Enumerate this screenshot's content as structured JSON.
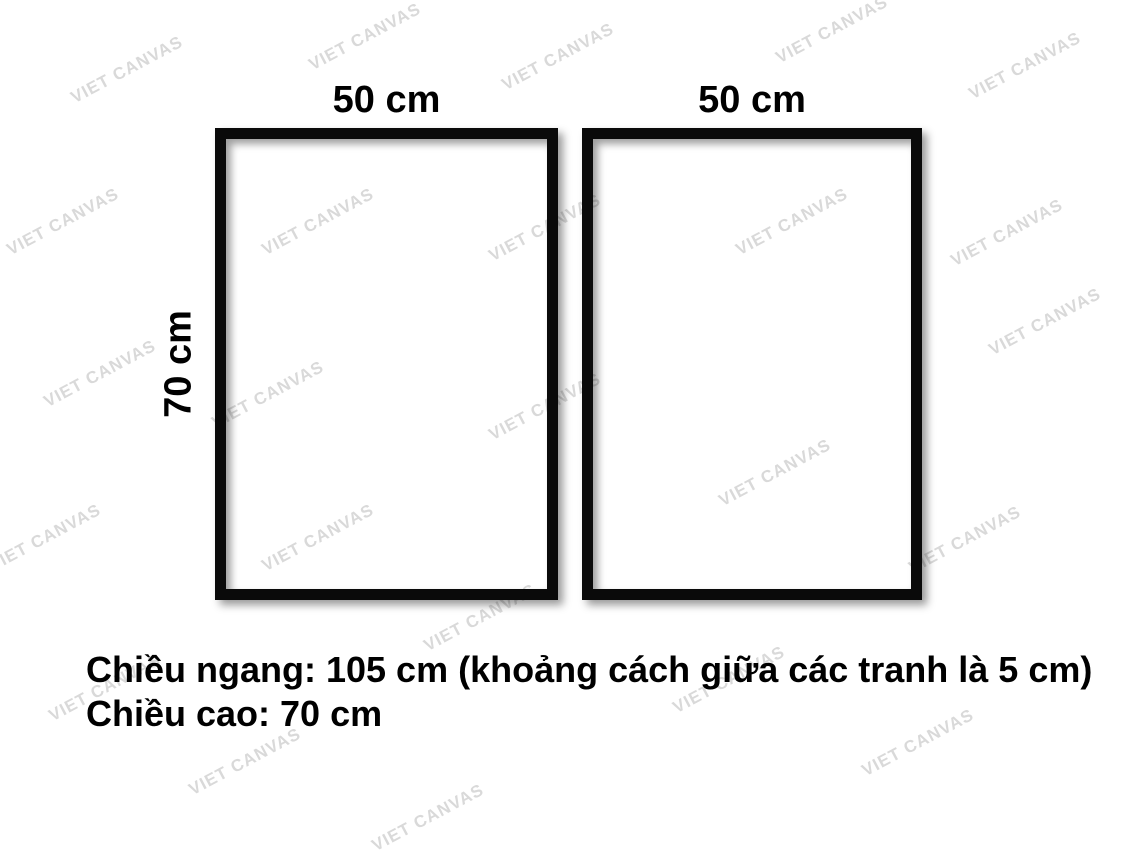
{
  "background_color": "#ffffff",
  "watermark": {
    "text": "VIET CANVAS",
    "color": "#d9d9d9",
    "angle_deg": -28,
    "positions": [
      {
        "x": 127,
        "y": 70
      },
      {
        "x": 365,
        "y": 37
      },
      {
        "x": 558,
        "y": 57
      },
      {
        "x": 832,
        "y": 30
      },
      {
        "x": 1025,
        "y": 66
      },
      {
        "x": 63,
        "y": 222
      },
      {
        "x": 318,
        "y": 222
      },
      {
        "x": 545,
        "y": 228
      },
      {
        "x": 792,
        "y": 222
      },
      {
        "x": 1007,
        "y": 233
      },
      {
        "x": 1045,
        "y": 322
      },
      {
        "x": 100,
        "y": 374
      },
      {
        "x": 268,
        "y": 395
      },
      {
        "x": 545,
        "y": 407
      },
      {
        "x": 775,
        "y": 473
      },
      {
        "x": 45,
        "y": 538
      },
      {
        "x": 318,
        "y": 538
      },
      {
        "x": 965,
        "y": 540
      },
      {
        "x": 480,
        "y": 618
      },
      {
        "x": 105,
        "y": 688
      },
      {
        "x": 729,
        "y": 680
      },
      {
        "x": 245,
        "y": 762
      },
      {
        "x": 918,
        "y": 743
      },
      {
        "x": 428,
        "y": 818
      }
    ]
  },
  "frames": [
    {
      "id": "left",
      "width_label": "50 cm",
      "height_label": "70 cm"
    },
    {
      "id": "right",
      "width_label": "50 cm"
    }
  ],
  "note": {
    "line1": "Chiều ngang: 105 cm (khoảng cách giữa các tranh là 5 cm)",
    "line2": "Chiều cao: 70 cm"
  },
  "colors": {
    "frame_border": "#0a0a0a",
    "label_text": "#000000"
  }
}
